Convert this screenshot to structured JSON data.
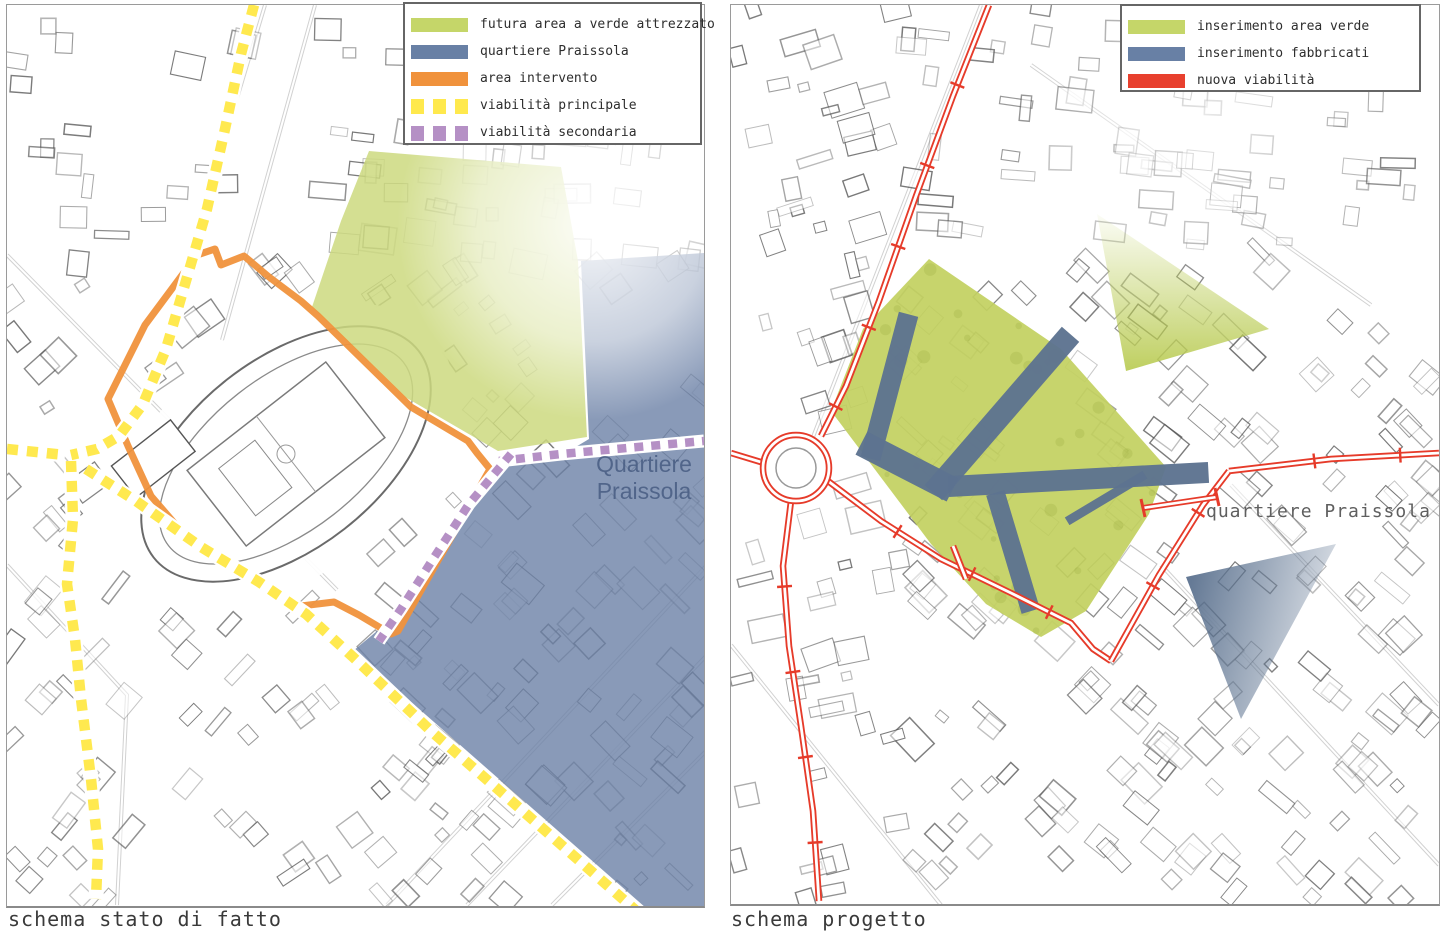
{
  "left_map": {
    "caption": "schema stato di fatto",
    "area_label_line1": "Quartiere",
    "area_label_line2": "Praissola",
    "legend": {
      "items": [
        {
          "label": "futura area a verde attrezzato",
          "swatch": "solid",
          "color": "#c5d669"
        },
        {
          "label": "quartiere Praissola",
          "swatch": "solid",
          "color": "#6880a5"
        },
        {
          "label": "area intervento",
          "swatch": "solid",
          "color": "#f0923c"
        },
        {
          "label": "viabilità principale",
          "swatch": "dashed",
          "color": "#ffe94d"
        },
        {
          "label": "viabilità secondaria",
          "swatch": "dashed",
          "color": "#b590c5"
        }
      ]
    }
  },
  "right_map": {
    "caption": "schema progetto",
    "area_label": "quartiere Praissola",
    "legend": {
      "items": [
        {
          "label": "inserimento area verde",
          "swatch": "solid",
          "color": "#c5d669"
        },
        {
          "label": "inserimento fabbricati",
          "swatch": "solid",
          "color": "#6880a5"
        },
        {
          "label": "nuova viabilità",
          "swatch": "solid",
          "color": "#e8402e"
        }
      ]
    }
  },
  "colors": {
    "green_area_left": "#cdd97f",
    "green_area_right": "#c2d05f",
    "blue_area": "#6c81a6",
    "building_fill": "#5d7390",
    "orange_boundary": "#f0923c",
    "yellow_road": "#ffe94f",
    "purple_road": "#b590c5",
    "red_road": "#e63b2a",
    "fabric_line": "#4a4a4a"
  }
}
